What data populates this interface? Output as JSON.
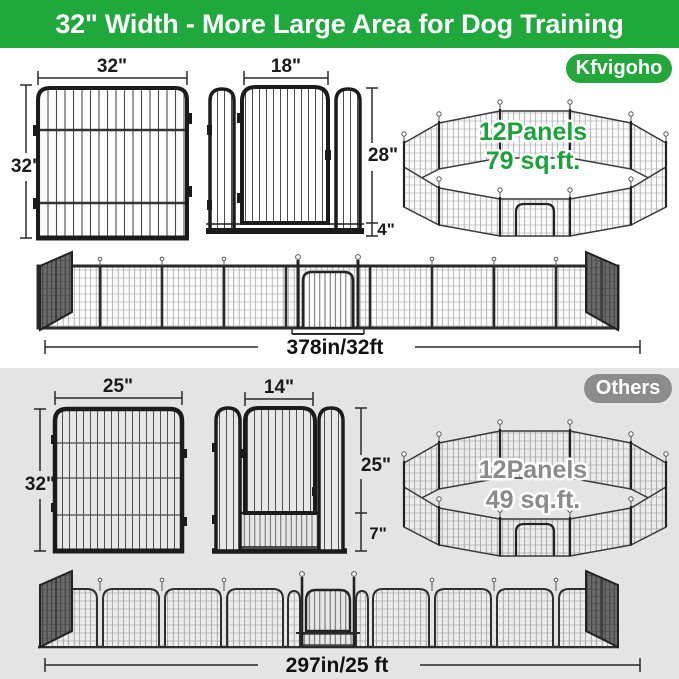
{
  "banner": {
    "title": "32\" Width - More Large Area for Dog Training"
  },
  "brand": {
    "badge": "Kfvigoho",
    "panel": {
      "width": "32\"",
      "height": "32\""
    },
    "door": {
      "width": "18\"",
      "height": "28\"",
      "bottom": "4\""
    },
    "playpen": {
      "panels": "12Panels",
      "area": "79 sq.ft."
    },
    "row_length": "378in/32ft"
  },
  "others": {
    "badge": "Others",
    "panel": {
      "width": "25\"",
      "height": "32\""
    },
    "door": {
      "width": "14\"",
      "height": "25\"",
      "bottom": "7\""
    },
    "playpen": {
      "panels": "12Panels",
      "area": "49 sq.ft."
    },
    "row_length": "297in/25 ft"
  },
  "colors": {
    "banner_green": "#1FA83C",
    "badge_green": "#23A73B",
    "badge_gray": "#8C8C8C",
    "playpen_label_green": "#1CA23A",
    "playpen_label_gray": "#8A8A8A",
    "others_section_bg": "#E4E4E4"
  }
}
